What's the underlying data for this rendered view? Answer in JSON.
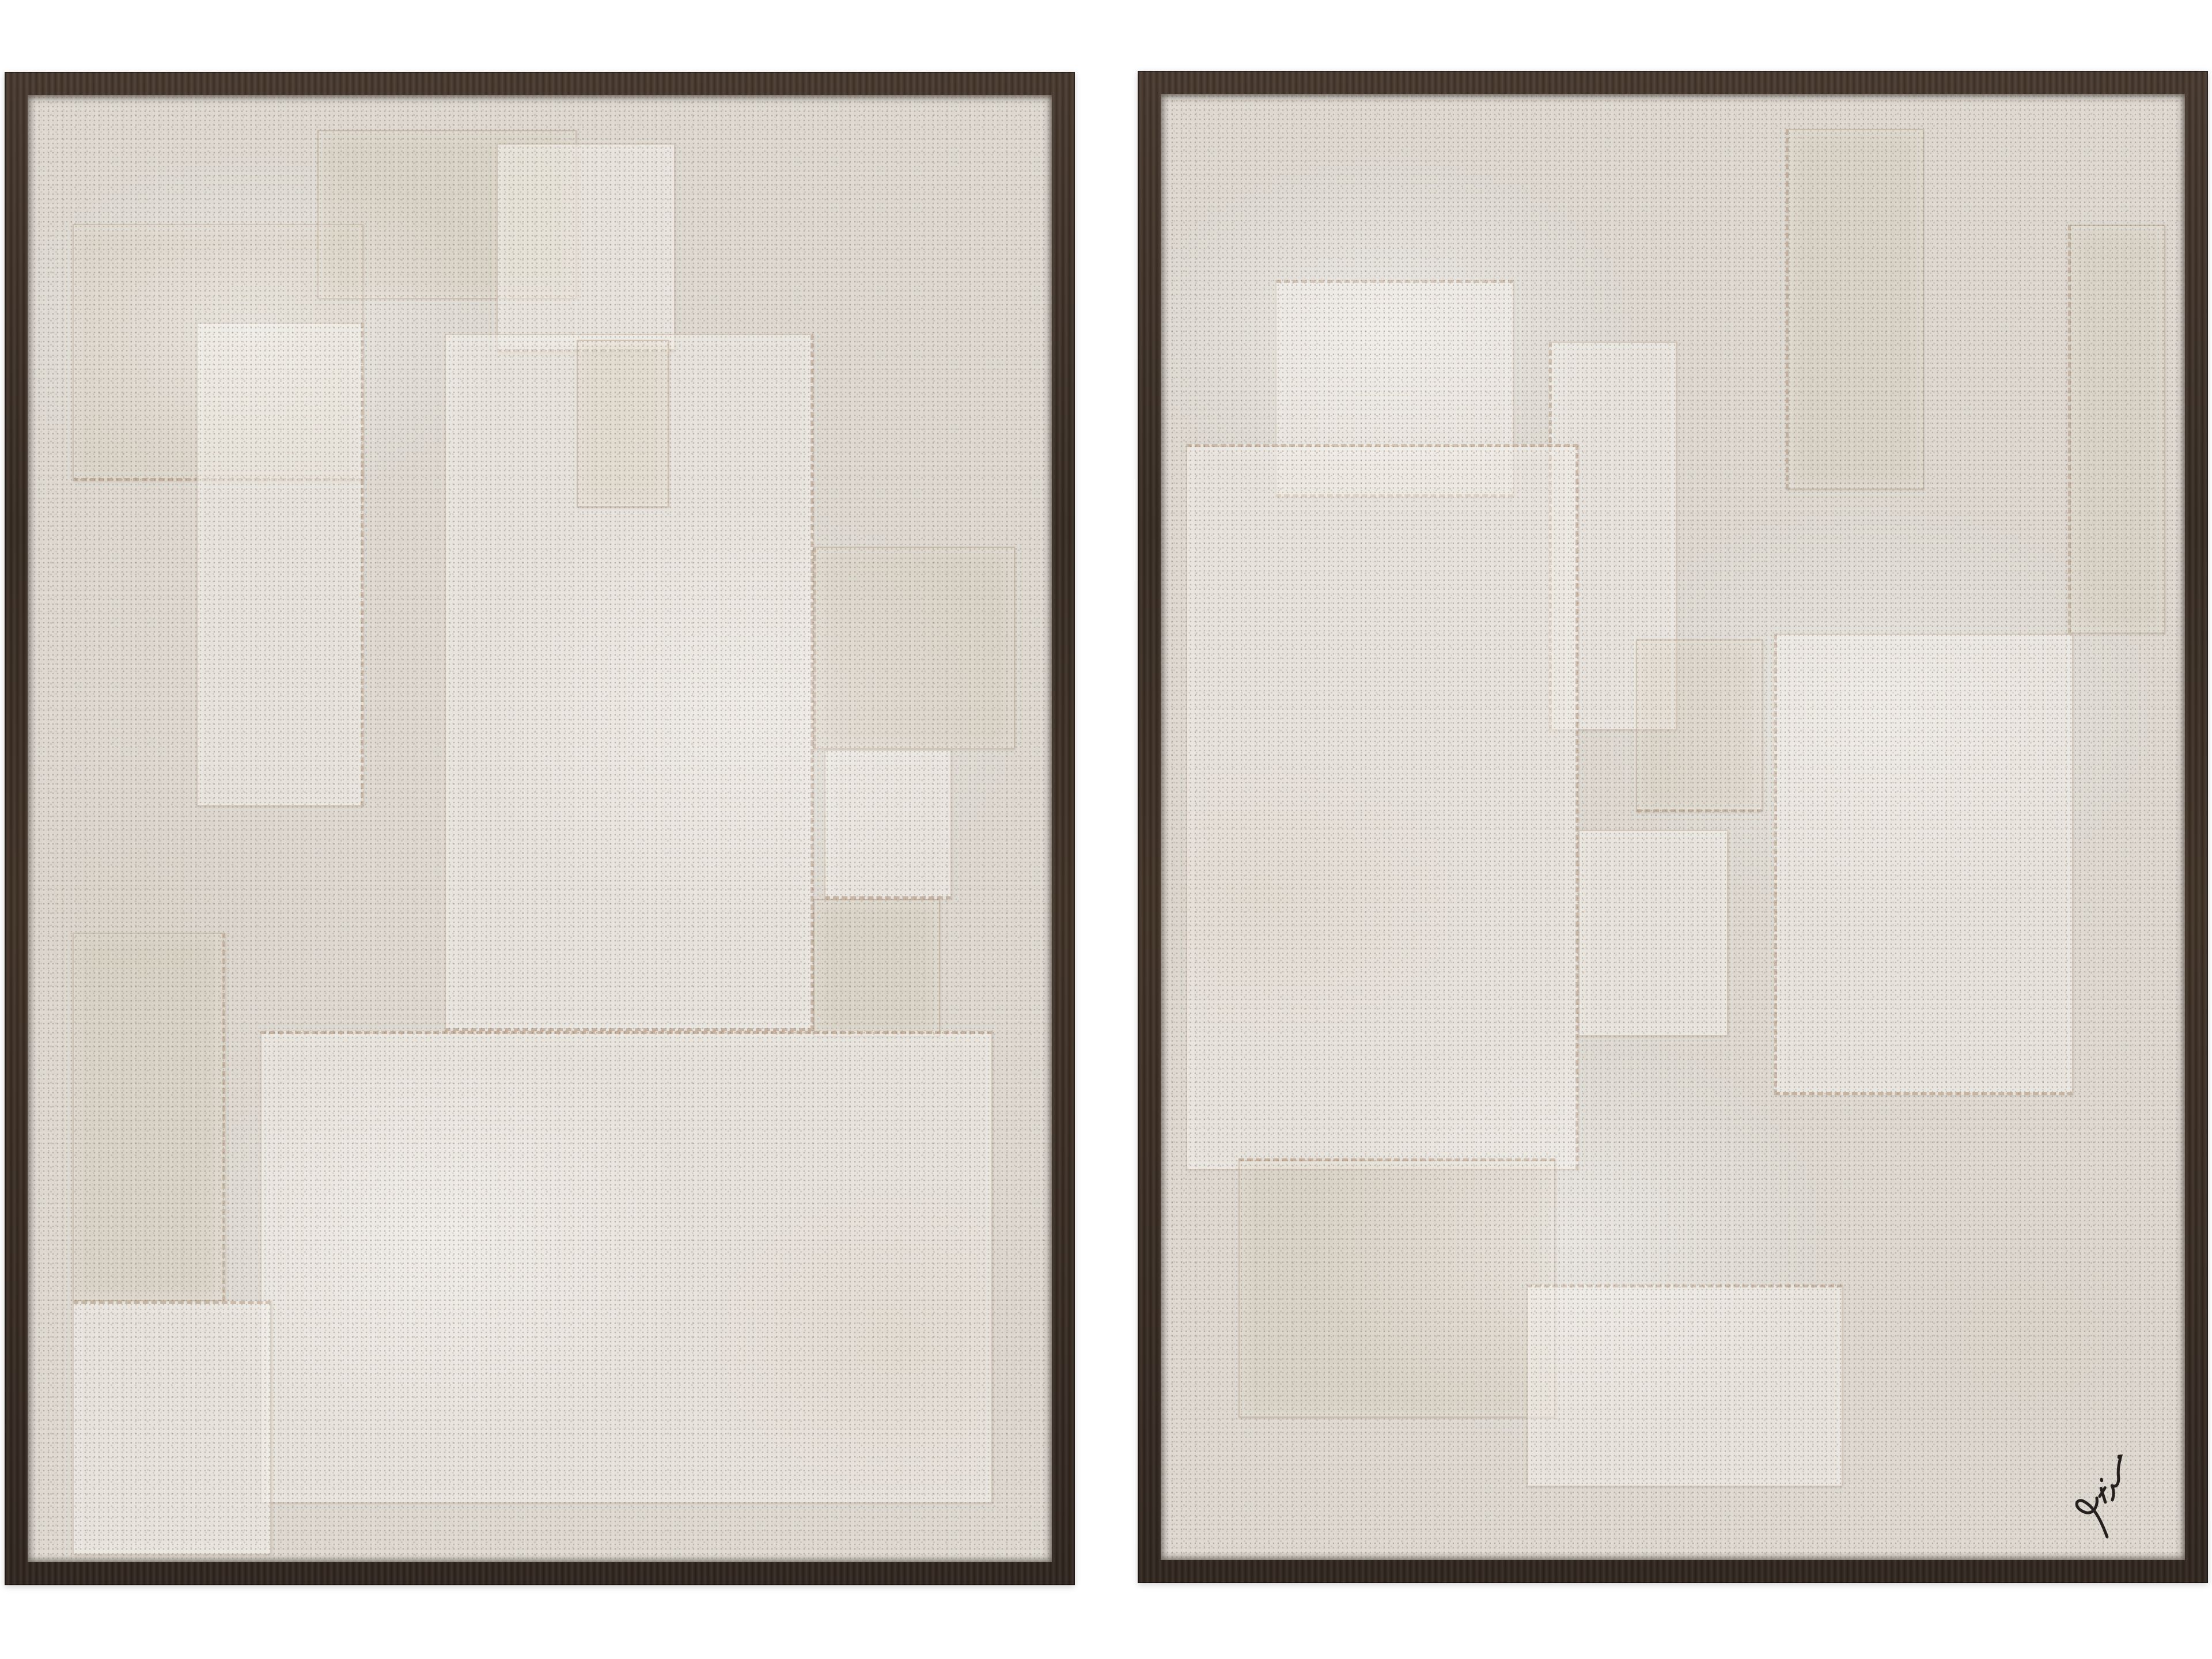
{
  "colors": {
    "background": "#ffffff",
    "frame_wood": "#3e3128",
    "frame_grain_highlight": "#5a4838",
    "canvas_fabric": "#dcd8d0",
    "speckle": "#6f6257",
    "seam": "#ac8d72",
    "signature_ink": "#24201d"
  },
  "signature": {
    "text": "Potishman",
    "location": "bottom-right of right panel"
  },
  "panels": [
    {
      "name": "left-canvas",
      "patches": [
        {
          "x": 4.4,
          "y": 8.8,
          "w": 28.4,
          "h": 17.5,
          "tone": "warm",
          "fray": [
            "bottom"
          ]
        },
        {
          "x": 16.5,
          "y": 15.5,
          "w": 16.3,
          "h": 33.0,
          "tone": "light",
          "fray": [
            "right"
          ]
        },
        {
          "x": 28.3,
          "y": 2.4,
          "w": 25.3,
          "h": 11.5,
          "tone": "warm",
          "fray": []
        },
        {
          "x": 45.8,
          "y": 3.3,
          "w": 17.4,
          "h": 14.2,
          "tone": "light",
          "fray": [
            "bottom"
          ]
        },
        {
          "x": 40.7,
          "y": 16.3,
          "w": 36.0,
          "h": 47.5,
          "tone": "light",
          "fray": [
            "bottom",
            "right"
          ]
        },
        {
          "x": 53.6,
          "y": 16.7,
          "w": 9.0,
          "h": 11.4,
          "tone": "warm",
          "fray": []
        },
        {
          "x": 76.7,
          "y": 30.8,
          "w": 19.7,
          "h": 13.8,
          "tone": "warm",
          "fray": [
            "left"
          ]
        },
        {
          "x": 77.8,
          "y": 44.6,
          "w": 12.4,
          "h": 10.2,
          "tone": "light",
          "fray": [
            "bottom"
          ]
        },
        {
          "x": 76.7,
          "y": 54.8,
          "w": 12.4,
          "h": 9.4,
          "tone": "warm",
          "fray": []
        },
        {
          "x": 22.7,
          "y": 63.8,
          "w": 71.5,
          "h": 32.2,
          "tone": "light",
          "fray": [
            "top"
          ]
        },
        {
          "x": 4.4,
          "y": 57.1,
          "w": 14.9,
          "h": 25.1,
          "tone": "warm",
          "fray": [
            "right"
          ]
        },
        {
          "x": 4.4,
          "y": 82.2,
          "w": 19.4,
          "h": 17.3,
          "tone": "light",
          "fray": [
            "top"
          ]
        }
      ],
      "has_signature": false
    },
    {
      "name": "right-canvas",
      "patches": [
        {
          "x": 11.2,
          "y": 12.7,
          "w": 23.3,
          "h": 14.8,
          "tone": "light",
          "fray": [
            "top",
            "bottom"
          ]
        },
        {
          "x": 37.9,
          "y": 16.9,
          "w": 12.5,
          "h": 26.5,
          "tone": "light",
          "fray": [
            "left"
          ]
        },
        {
          "x": 2.5,
          "y": 23.9,
          "w": 38.3,
          "h": 49.5,
          "tone": "light",
          "fray": [
            "top",
            "right"
          ]
        },
        {
          "x": 61.0,
          "y": 2.4,
          "w": 13.5,
          "h": 24.6,
          "tone": "warm",
          "fray": [
            "left"
          ]
        },
        {
          "x": 46.4,
          "y": 37.2,
          "w": 12.4,
          "h": 11.8,
          "tone": "warm",
          "fray": [
            "bottom"
          ]
        },
        {
          "x": 59.9,
          "y": 36.8,
          "w": 29.2,
          "h": 31.5,
          "tone": "light",
          "fray": [
            "left",
            "bottom"
          ]
        },
        {
          "x": 40.8,
          "y": 50.2,
          "w": 14.6,
          "h": 14.1,
          "tone": "light",
          "fray": []
        },
        {
          "x": 7.6,
          "y": 72.6,
          "w": 30.9,
          "h": 17.7,
          "tone": "warm",
          "fray": [
            "top"
          ]
        },
        {
          "x": 35.7,
          "y": 81.2,
          "w": 30.9,
          "h": 13.8,
          "tone": "light",
          "fray": [
            "top"
          ]
        },
        {
          "x": 88.6,
          "y": 8.9,
          "w": 9.5,
          "h": 27.9,
          "tone": "warm",
          "fray": [
            "left"
          ]
        }
      ],
      "has_signature": true
    }
  ]
}
